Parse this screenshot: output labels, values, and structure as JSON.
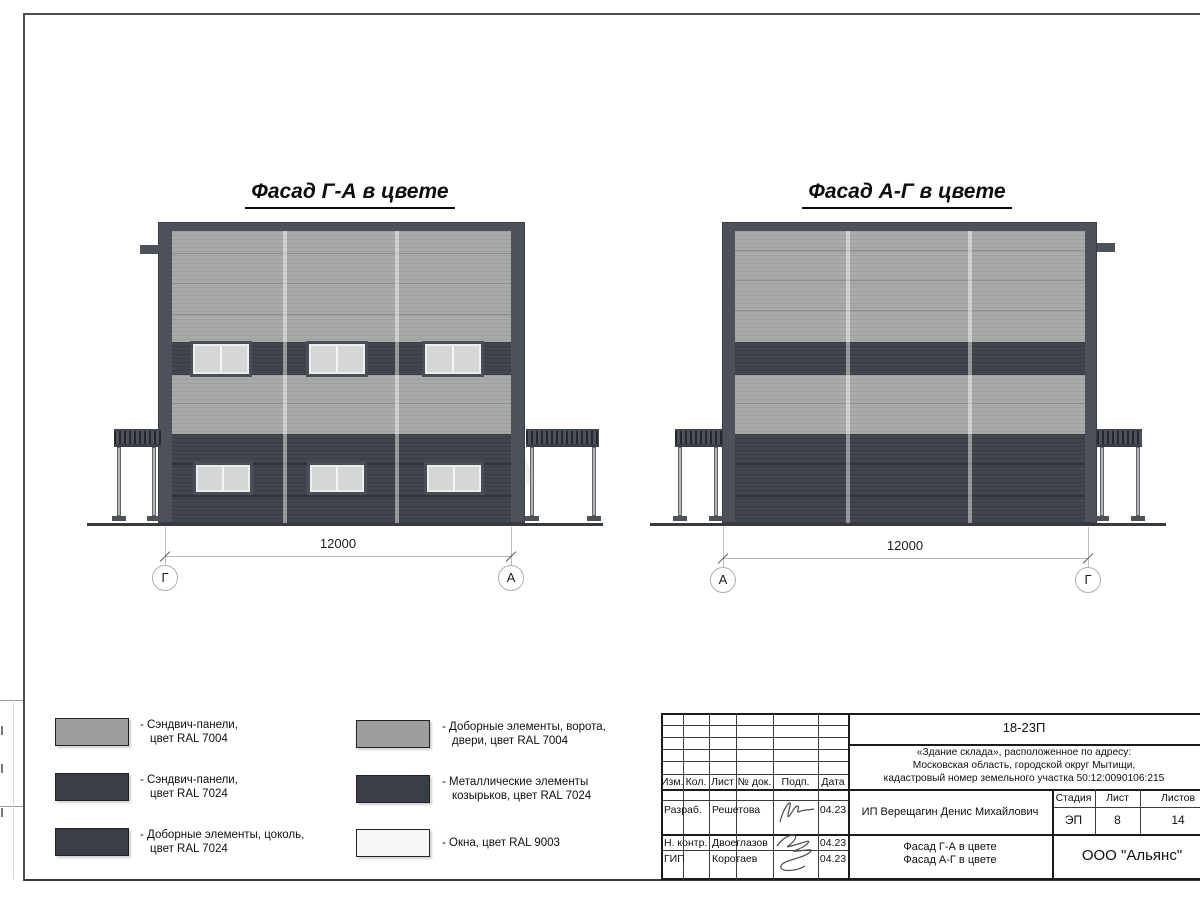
{
  "colors": {
    "ral7004_light_gray": "#a6a8a7",
    "ral7024_graphite_gray": "#3e434b",
    "ral9003_signal_white": "#f5f6f6",
    "frame_dark": "#4c515a"
  },
  "facades": {
    "left": {
      "title": "Фасад Г-А в цвете",
      "dimension": "12000",
      "axes": [
        "Г",
        "А"
      ]
    },
    "right": {
      "title": "Фасад А-Г в цвете",
      "dimension": "12000",
      "axes": [
        "А",
        "Г"
      ]
    }
  },
  "watermark_letter": "А",
  "legend": {
    "items": [
      {
        "swatch_color": "#9c9e9d",
        "line1": "- Сэндвич-панели,",
        "line2": "цвет RAL 7004"
      },
      {
        "swatch_color": "#3a3f47",
        "line1": "- Сэндвич-панели,",
        "line2": "цвет RAL 7024"
      },
      {
        "swatch_color": "#3a3f47",
        "line1": "- Доборные элементы, цоколь,",
        "line2": "цвет RAL 7024"
      },
      {
        "swatch_color": "#9c9e9d",
        "line1": "- Доборные элементы, ворота,",
        "line2": "двери, цвет RAL 7004"
      },
      {
        "swatch_color": "#3a3f47",
        "line1": "- Металлические элементы",
        "line2": "козырьков, цвет RAL 7024"
      },
      {
        "swatch_color": "#f5f6f6",
        "line1": "- Окна, цвет RAL 9003",
        "line2": ""
      }
    ]
  },
  "title_block": {
    "doc_number": "18-23П",
    "project_line1": "«Здание склада», расположенное по адресу:",
    "project_line2": "Московская область, городской округ Мытищи,",
    "project_line3": "кадастровый номер земельного участка 50:12:0090106:215",
    "headers": {
      "izm": "Изм.",
      "kol": "Кол.",
      "list": "Лист",
      "doc": "№ док.",
      "podp": "Подп.",
      "data": "Дата",
      "stage": "Стадия",
      "sheet": "Лист",
      "sheets": "Листов"
    },
    "rows": [
      {
        "role": "Разраб.",
        "name": "Решетова",
        "date": "04.23"
      },
      {
        "role": "Н. контр.",
        "name": "Двоеглазов",
        "date": "04.23"
      },
      {
        "role": "ГИП",
        "name": "Коротаев",
        "date": "04.23"
      }
    ],
    "client": "ИП Верещагин Денис Михайлович",
    "stage_value": "ЭП",
    "sheet_value": "8",
    "sheets_value": "14",
    "sheet_title_line1": "Фасад Г-А в цвете",
    "sheet_title_line2": "Фасад А-Г в цвете",
    "organization": "ООО \"Альянс\""
  }
}
